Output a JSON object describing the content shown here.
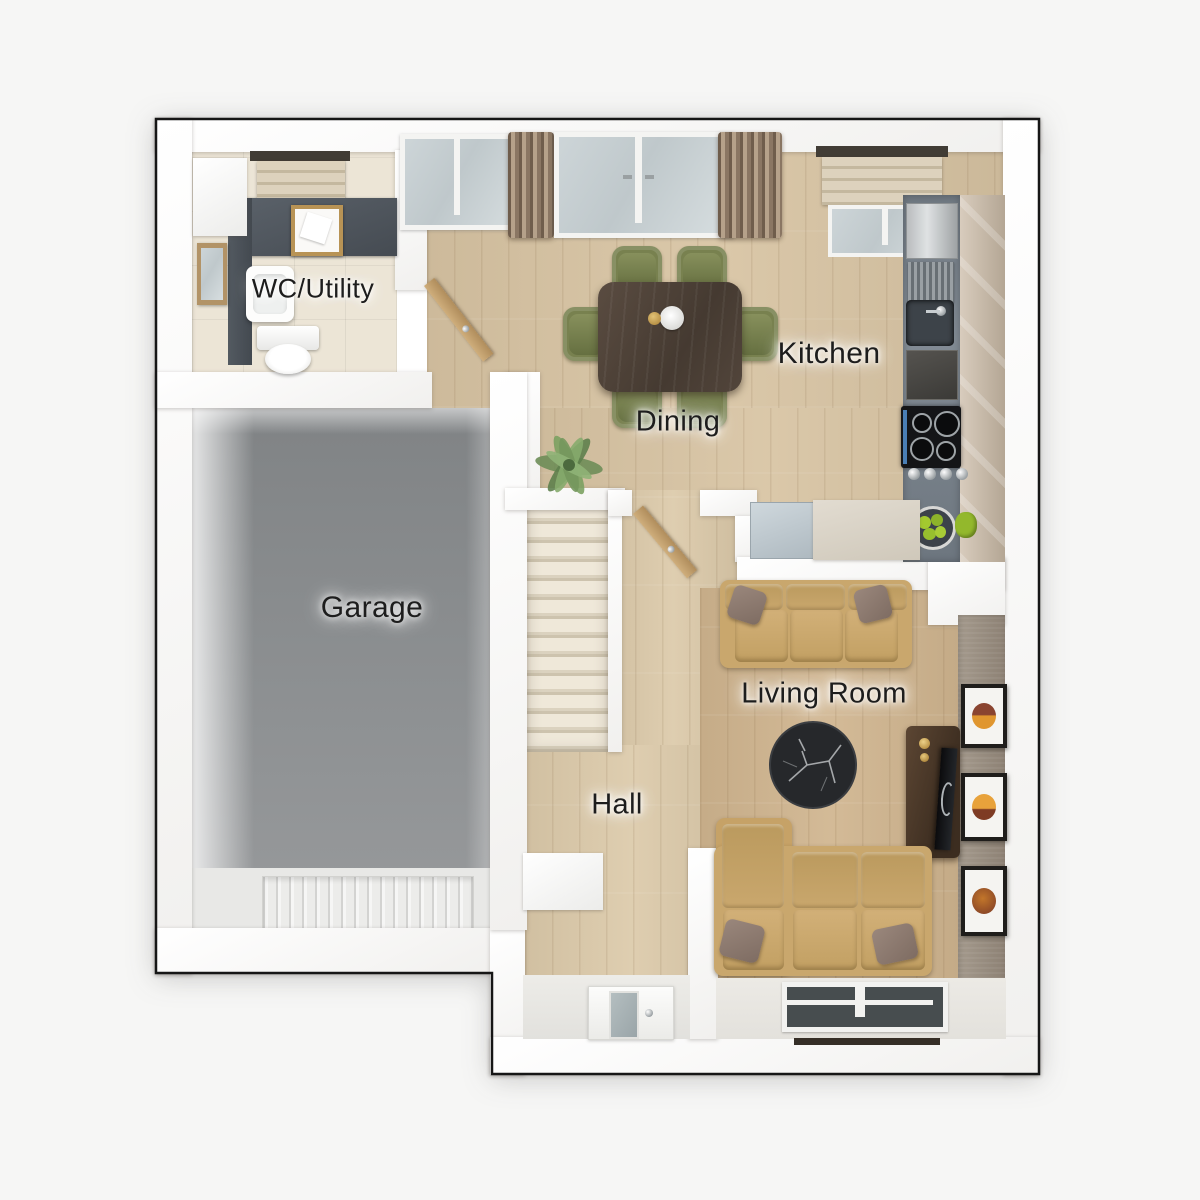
{
  "scene": {
    "type": "3d top-down floor plan render",
    "rooms": [
      {
        "label": "WC/Utility"
      },
      {
        "label": "Dining"
      },
      {
        "label": "Kitchen"
      },
      {
        "label": "Garage"
      },
      {
        "label": "Hall"
      },
      {
        "label": "Living Room"
      }
    ]
  },
  "furniture": {
    "wc_utility": [
      "worktop with washer area",
      "laundry-basket",
      "washbasin",
      "mirror",
      "toilet",
      "storage-cabinet",
      "window-blind"
    ],
    "dining": [
      "dining-table",
      "green-chairs-x6",
      "centerpiece",
      "potted-plant",
      "window",
      "french-doors",
      "curtains"
    ],
    "kitchen": [
      "slate-worktop",
      "tall-gloss-cabinets",
      "appliance",
      "dish-rack",
      "sink",
      "oven",
      "hob-4-ring",
      "control-knobs",
      "fruit-bowl",
      "roman-blind",
      "peninsula-counter",
      "dishwasher"
    ],
    "hall": [
      "staircase-13-steps",
      "interior-door",
      "console-cabinet",
      "front-door-with-glazing"
    ],
    "living_room": [
      "three-seat-sofa",
      "second-sofa-with-chaise",
      "round-marble-coffee-table",
      "tv-unit",
      "tv",
      "wall-art-x3",
      "window",
      "radiator-shelf",
      "accent-wall"
    ],
    "garage": [
      "sectional-garage-door",
      "service-door"
    ]
  },
  "colors": {
    "background": "#f6f6f5",
    "outline": "#161616",
    "wall": "#fbfbfa",
    "wood_floor": "#d8c4a3",
    "hall_floor": "#dccaaa",
    "living_floor": "#d0b58f",
    "wc_tile": "#ece5d6",
    "garage_floor": "#8b8e90",
    "stairs_carpet": "#e9e1d1",
    "accent_wall": "#978b7e",
    "worktop_slate": "#75808a",
    "cabinet_beige": "#c9bcab",
    "sofa_tan": "#c9a76d",
    "pillow_taupe": "#8d7970",
    "table_walnut": "#4d4138",
    "chair_olive": "#78814f",
    "marble_black": "#2c2f32",
    "curtain_brown": "#8d7a64",
    "label_text": "#1d1d1d"
  }
}
